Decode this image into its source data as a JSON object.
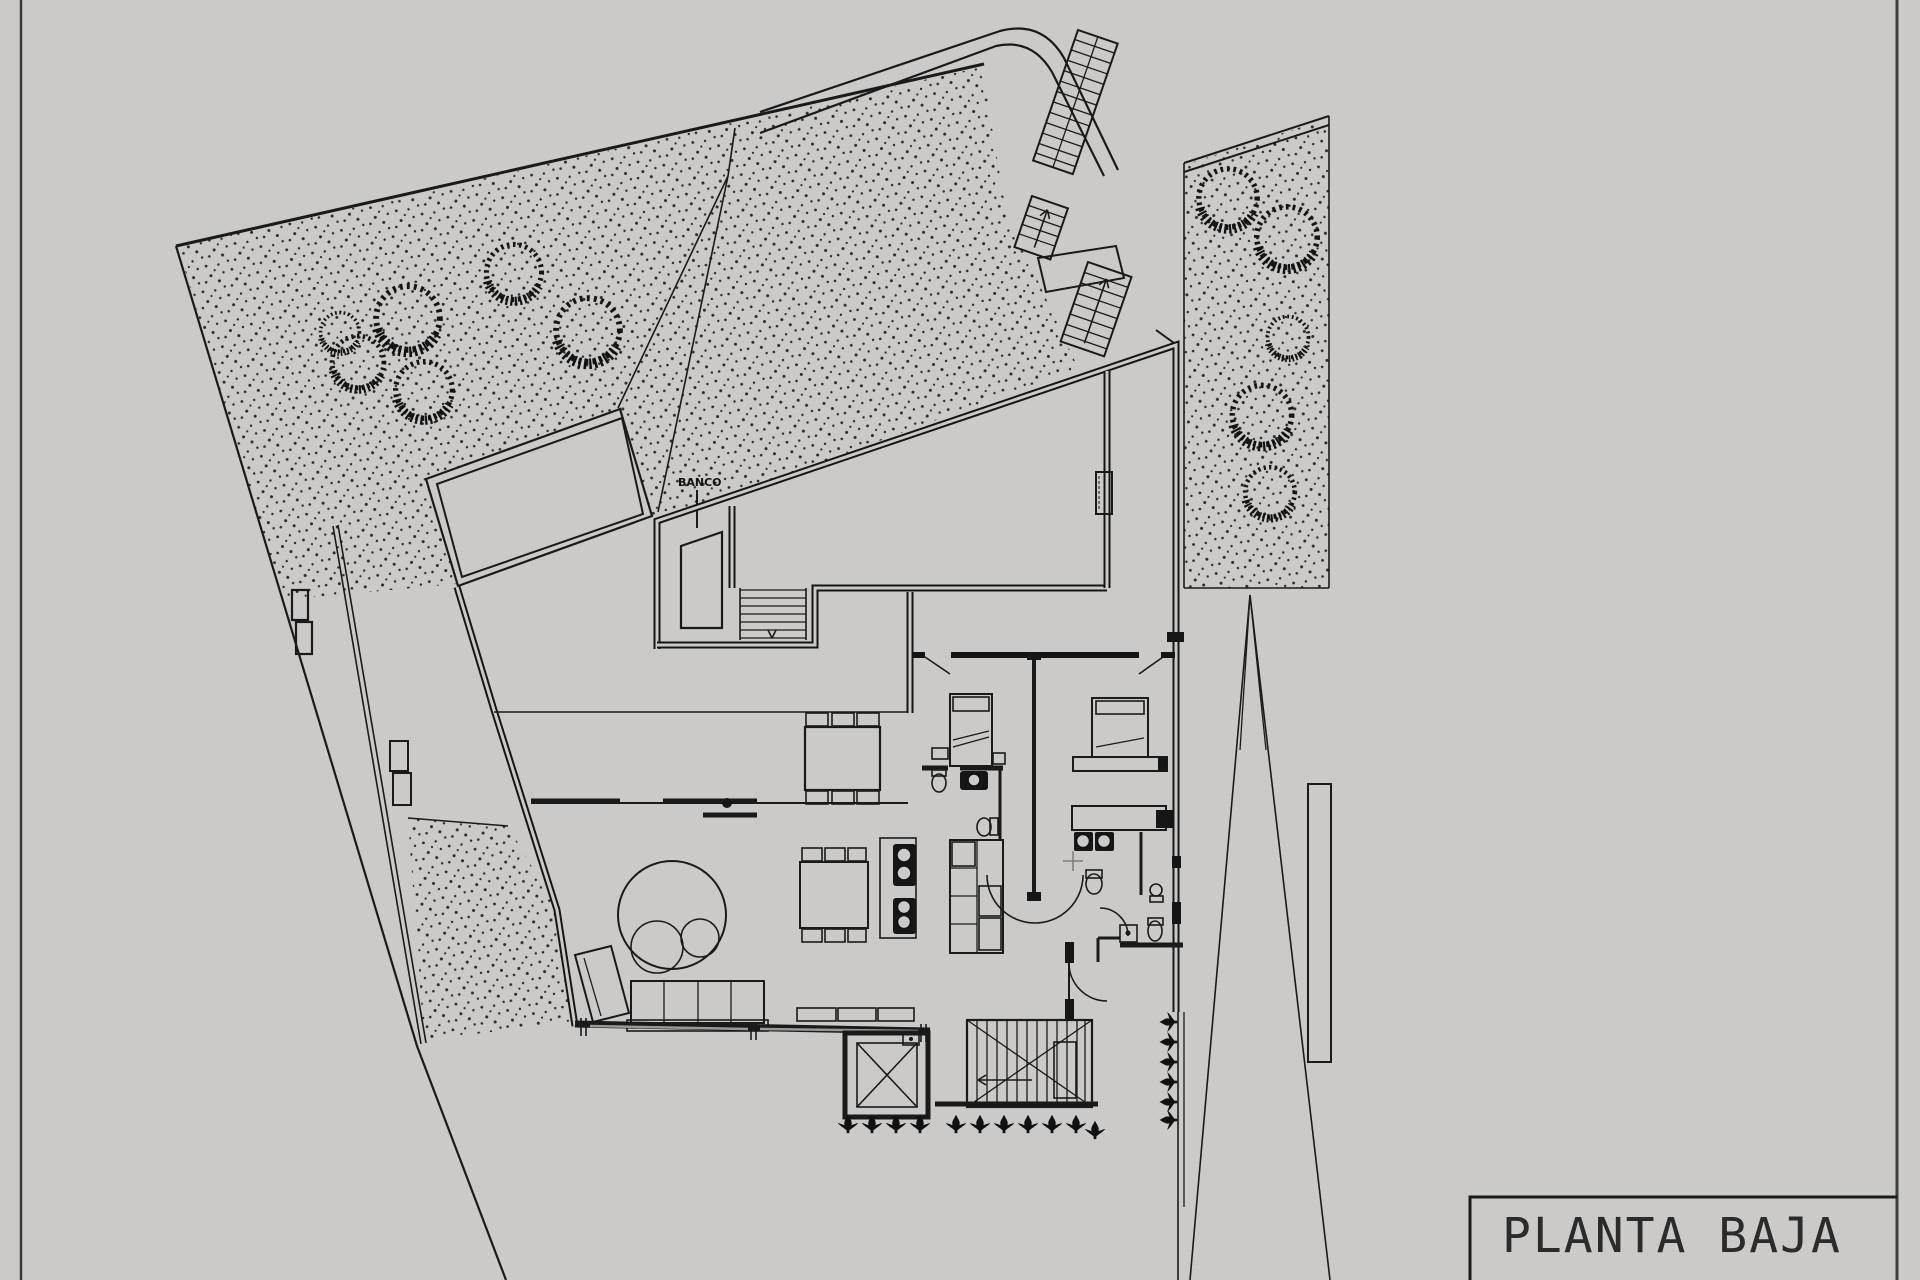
{
  "sheet": {
    "background_color": "#cbcac8",
    "ink_color": "#1a1a1a",
    "kind": "architectural floor plan drawing"
  },
  "title_block": {
    "label": "PLANTA BAJA"
  },
  "labels": {
    "pool_bench": "BANCO"
  }
}
